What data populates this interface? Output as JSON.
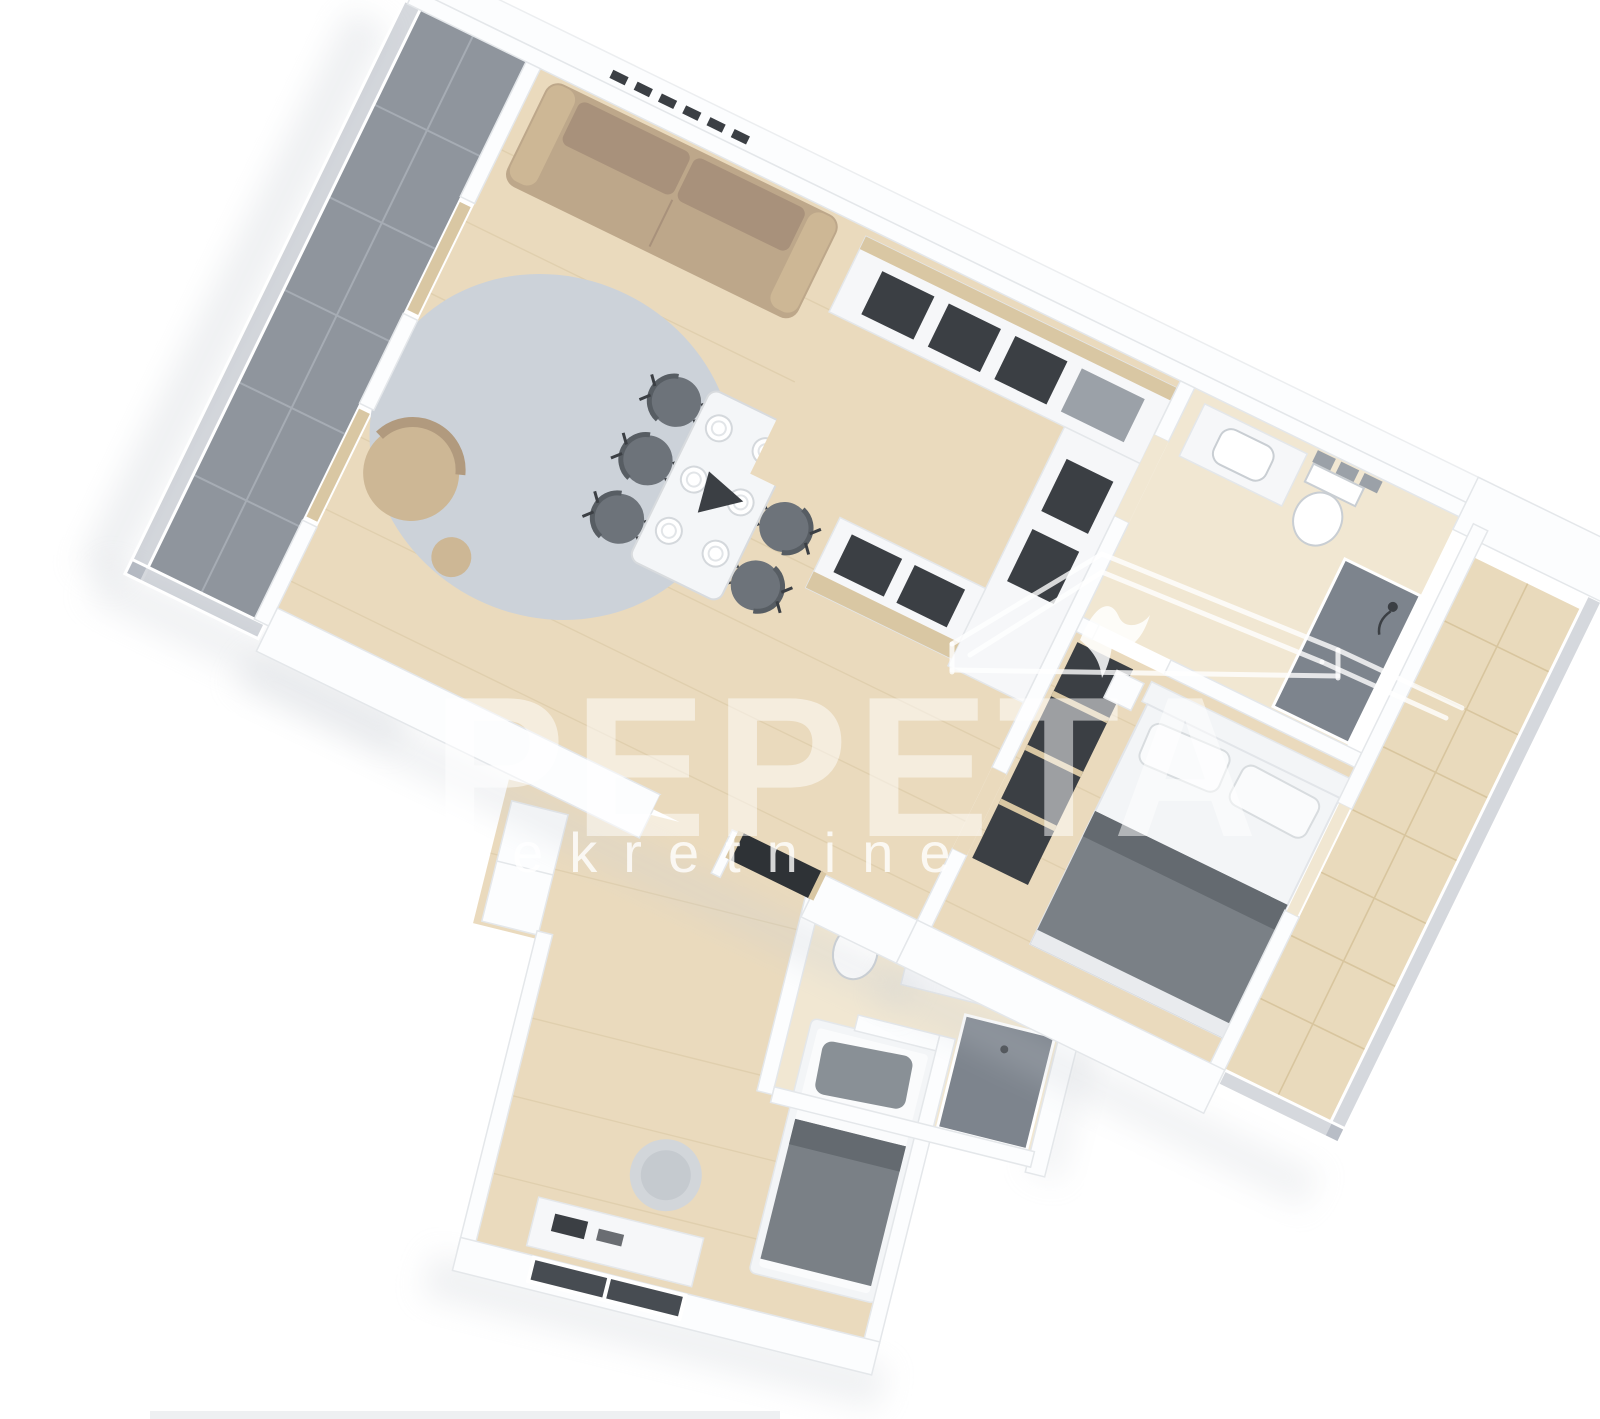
{
  "watermark": {
    "brand": "PEPETA",
    "subtitle": "nekretnine",
    "logo_icon": "house-roof-swallow"
  },
  "colors": {
    "background": "#ffffff",
    "wall": "#fcfdfe",
    "wall_line": "#e4e7ea",
    "wood": "#eadabd",
    "wood_line": "#d9c7a3",
    "wood_light": "#f1e7d2",
    "balcony_tile": "#8f959d",
    "balcony_line": "#a6acb4",
    "terrace_tile": "#e9dabc",
    "terrace_line": "#d8c59e",
    "glass": "#7d8794",
    "rug": "#ccd2d9",
    "sofa": "#bda78a",
    "sofa_shade": "#a8917b",
    "armchair": "#cdb795",
    "chair": "#6d737a",
    "table": "#f4f6f8",
    "plate": "#ffffff",
    "counter": "#f6f7f9",
    "cabinet": "#3b3f44",
    "appliance": "#9ba1a8",
    "bed": "#f3f5f7",
    "blanket": "#7a8086",
    "blanket_dark": "#646a70",
    "pillow": "#fafbfc",
    "pillow_gray": "#899096",
    "fixture": "#ffffff",
    "fixture_line": "#c9ced3",
    "shower": "#7d848d",
    "dark_opening": "#2e3236",
    "window": "#474c52",
    "shadow": "#c9ced4",
    "watermark": "#ffffff"
  }
}
